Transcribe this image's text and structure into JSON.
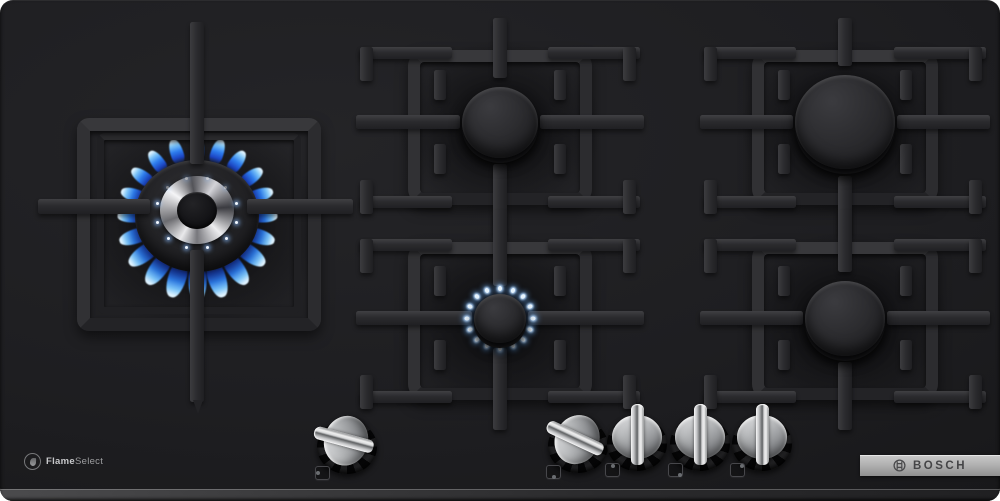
{
  "branding": {
    "logo_text": "BOSCH",
    "badge_flame": "Flame",
    "badge_select": "Select"
  },
  "scene": {
    "colors": {
      "glass": "#1d1d1f",
      "grate": "#2c2c2f",
      "flame_blue": "#2f7ff0",
      "flame_tip": "#dff3ff",
      "knob_silver": "#c9cbcd",
      "bosch_strip_silver": "#b2b2b2"
    },
    "burners": [
      {
        "id": "wok",
        "cx": 197,
        "cy": 216,
        "cap_r": 62,
        "state": "on-high",
        "flame_count": 20,
        "flame_r": 67
      },
      {
        "id": "top-center",
        "cx": 500,
        "cy": 122,
        "cap_r": 38,
        "state": "off"
      },
      {
        "id": "top-right",
        "cx": 845,
        "cy": 122,
        "cap_r": 50,
        "state": "off"
      },
      {
        "id": "bottom-center",
        "cx": 500,
        "cy": 318,
        "cap_r": 26,
        "state": "on-simmer",
        "flame_count": 16,
        "flame_r": 33
      },
      {
        "id": "bottom-right",
        "cx": 845,
        "cy": 318,
        "cap_r": 40,
        "state": "off"
      }
    ],
    "zones": [
      {
        "burner": "top-center",
        "l": 408,
        "t": 50,
        "r": 592,
        "b": 205
      },
      {
        "burner": "top-right",
        "l": 752,
        "t": 50,
        "r": 938,
        "b": 205
      },
      {
        "burner": "bottom-center",
        "l": 408,
        "t": 242,
        "r": 592,
        "b": 400
      },
      {
        "burner": "bottom-right",
        "l": 752,
        "t": 242,
        "r": 938,
        "b": 400
      }
    ],
    "wok": {
      "outer_frame": [
        77,
        118,
        244,
        213
      ],
      "inner_frame": [
        97,
        133,
        204,
        181
      ],
      "bars": [
        {
          "x": 190,
          "y": 22,
          "w": 14,
          "h": 142,
          "dir": "v"
        },
        {
          "x": 190,
          "y": 250,
          "w": 14,
          "h": 152,
          "dir": "v"
        },
        {
          "x": 38,
          "y": 199,
          "w": 112,
          "h": 15,
          "dir": "h"
        },
        {
          "x": 247,
          "y": 199,
          "w": 106,
          "h": 15,
          "dir": "h"
        }
      ],
      "chrome_ring_r": 37,
      "center_cap_r": 20,
      "sparkle_count": 12,
      "sparkle_r": 41
    },
    "knobs": [
      {
        "id": "wok-burner",
        "x": 347,
        "y": 443,
        "rot": -75,
        "state": "on",
        "dot": [
          -3,
          0
        ]
      },
      {
        "id": "bottom-center-burner",
        "x": 578,
        "y": 442,
        "rot": -65,
        "state": "on",
        "dot": [
          0,
          3
        ]
      },
      {
        "id": "top-center-burner",
        "x": 637,
        "y": 440,
        "rot": 0,
        "state": "off",
        "dot": [
          0,
          -3
        ]
      },
      {
        "id": "bottom-right-burner",
        "x": 700,
        "y": 440,
        "rot": 0,
        "state": "off",
        "dot": [
          3,
          3
        ]
      },
      {
        "id": "top-right-burner",
        "x": 762,
        "y": 440,
        "rot": 0,
        "state": "off",
        "dot": [
          3,
          -3
        ]
      }
    ]
  }
}
